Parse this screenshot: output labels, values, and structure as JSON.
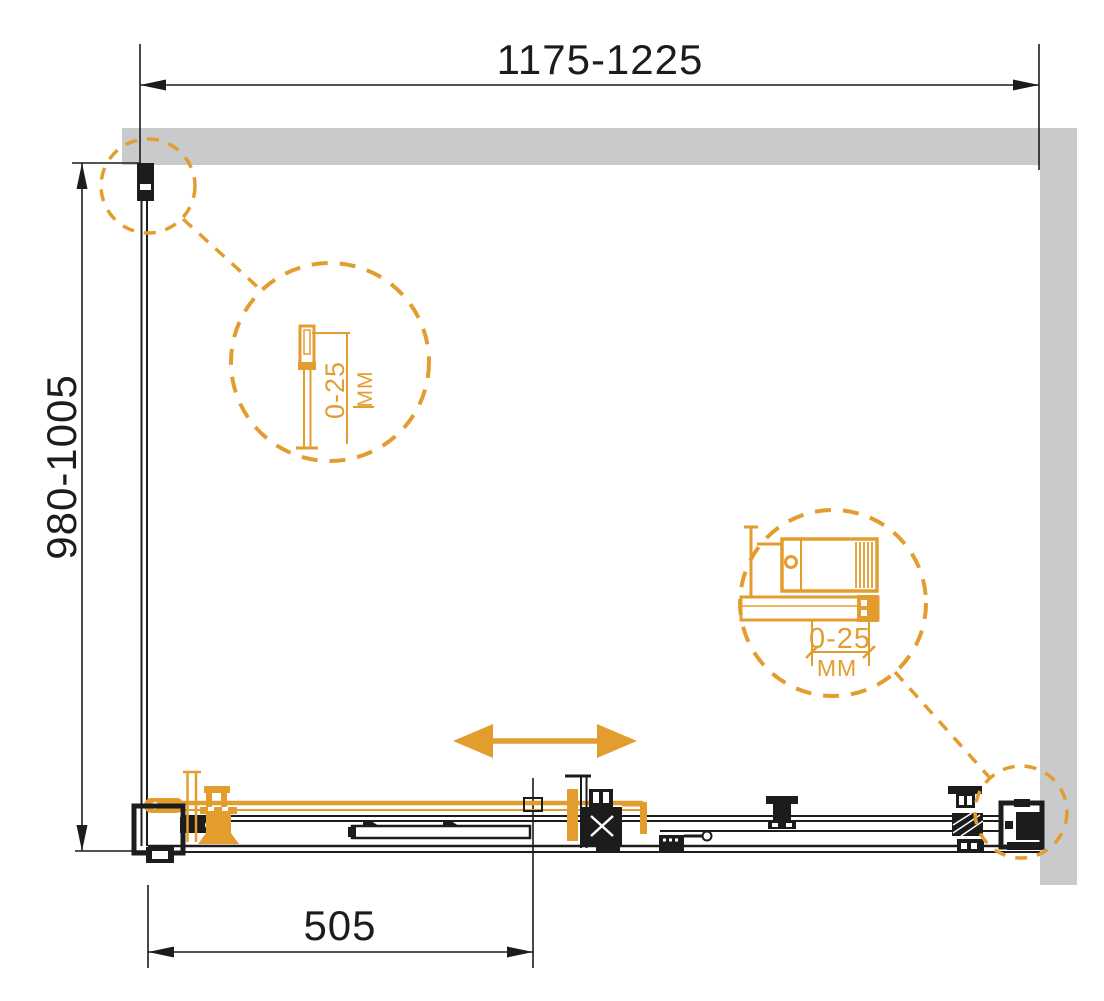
{
  "dimensions": {
    "width": "1175-1225",
    "depth": "980-1005",
    "door": "505"
  },
  "details": {
    "left": {
      "range": "0-25",
      "unit": "MM"
    },
    "right": {
      "range": "0-25",
      "unit": "MM"
    }
  },
  "colors": {
    "accent": "#E39D2F",
    "wall": "#C9CACB",
    "line": "#1C1C1C",
    "bg": "#FFFFFF"
  }
}
